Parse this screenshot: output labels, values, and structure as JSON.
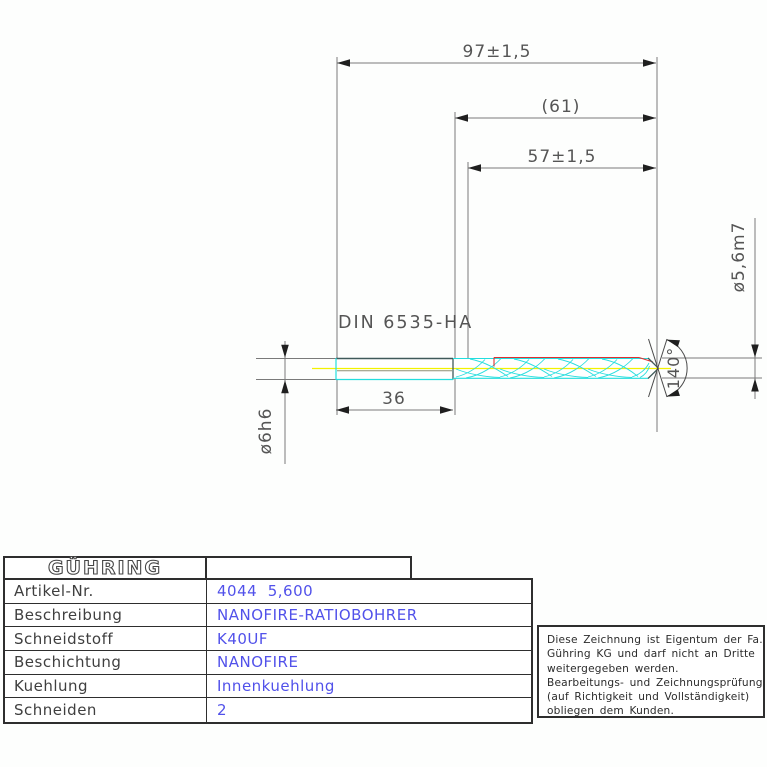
{
  "drawing": {
    "standard_label": "DIN 6535-HA",
    "dim_overall_length": "97±1,5",
    "dim_ref_length": "(61)",
    "dim_flute_length": "57±1,5",
    "dim_shank_length": "36",
    "dim_tip_diameter": "ø5,6m7",
    "dim_shank_diameter": "ø6h6",
    "dim_point_angle": "140°",
    "colors": {
      "outline_cyan": "#22dede",
      "centerline_yellow": "#f2f200",
      "coating_red": "#e03030",
      "label_blue": "#5151ea",
      "dim_gray": "#7a7a7a"
    }
  },
  "table": {
    "brand": "GÜHRING",
    "rows": [
      {
        "label": "Artikel-Nr.",
        "value": "4044  5,600"
      },
      {
        "label": "Beschreibung",
        "value": "NANOFIRE-RATIOBOHRER"
      },
      {
        "label": "Schneidstoff",
        "value": "K40UF"
      },
      {
        "label": "Beschichtung",
        "value": "NANOFIRE"
      },
      {
        "label": "Kuehlung",
        "value": "Innenkuehlung"
      },
      {
        "label": "Schneiden",
        "value": "2"
      }
    ]
  },
  "note": {
    "lines": [
      "Diese Zeichnung ist Eigentum der Fa.",
      "Gühring KG und darf nicht an Dritte",
      "weitergegeben werden.",
      "Bearbeitungs- und Zeichnungsprüfung",
      "(auf Richtigkeit und Vollständigkeit)",
      "obliegen dem Kunden."
    ]
  }
}
